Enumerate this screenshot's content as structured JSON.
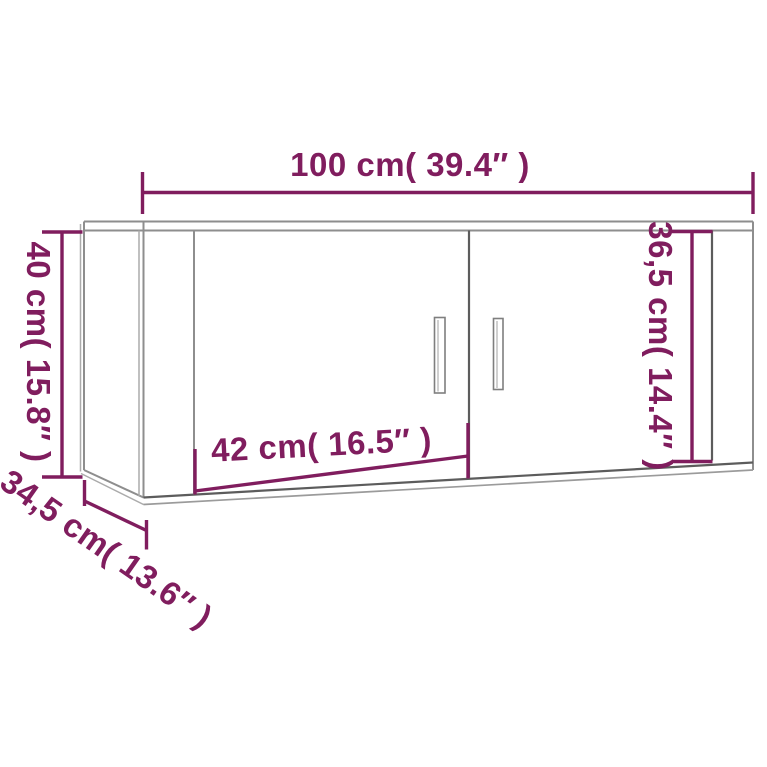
{
  "page": {
    "background": "#ffffff",
    "description_label": "Wall-mounted TV cabinet dimension diagram"
  },
  "colors": {
    "dimension_accent": "#801d5e",
    "line_medium": "#8e8e8e",
    "line_dark": "#5c5c5c",
    "line_light": "#ababab"
  },
  "product": {
    "dimensions": {
      "width": {
        "label": "100 cm( 39.4″ )",
        "cm": "100",
        "inches": "39.4"
      },
      "height": {
        "label": "40 cm( 15.8″ )",
        "cm": "40",
        "inches": "15.8"
      },
      "depth": {
        "label": "34,5 cm( 13.6″ )",
        "cm": "34,5",
        "inches": "13.6"
      },
      "door_width": {
        "label": "42 cm( 16.5″ )",
        "cm": "42",
        "inches": "16.5"
      },
      "door_height": {
        "label": "36,5 cm( 14.4″ )",
        "cm": "36,5",
        "inches": "14.4"
      }
    }
  }
}
